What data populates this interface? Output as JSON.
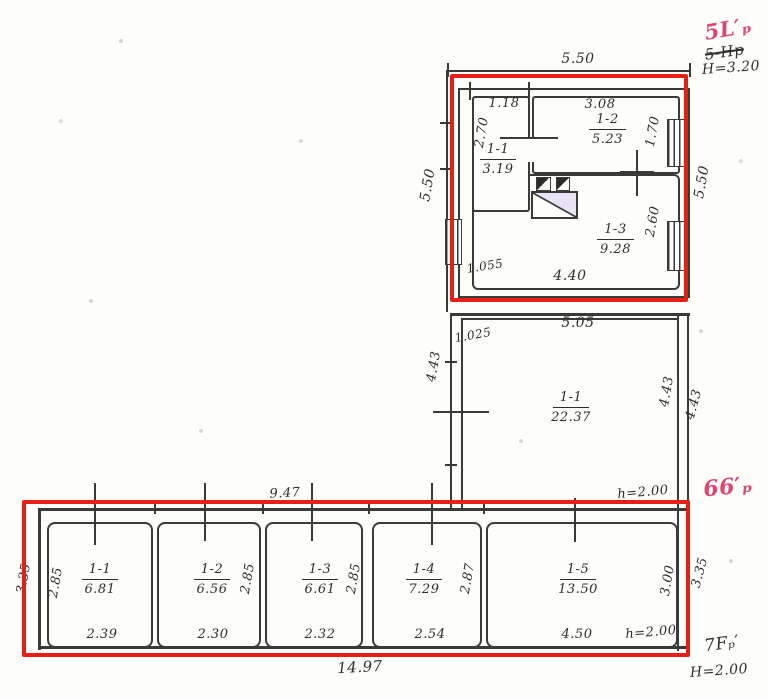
{
  "colors": {
    "red_box": "#e81f15",
    "pink": "#e0476f",
    "ink": "#3a3a38"
  },
  "annotations": {
    "top_right": {
      "pink_label": "5L′ₚ",
      "struck_label": "5-Hp",
      "height_note": "H=3.20"
    },
    "mid_right": {
      "pink_label": "66′ₚ"
    },
    "bottom_right": {
      "label": "7Fₚ′",
      "height_note": "H=2.00"
    }
  },
  "top_unit": {
    "dim_top": "5.50",
    "dim_left": "5.50",
    "dim_right": "5.50",
    "dim_small": "1.055",
    "dim_bottom": "4.40",
    "rooms": [
      {
        "id": "1-1",
        "area": "3.19",
        "dim_w": "1.18",
        "dim_h": "2.70"
      },
      {
        "id": "1-2",
        "area": "5.23",
        "dim_w": "3.08",
        "dim_h": "1.70"
      },
      {
        "id": "1-3",
        "area": "9.28",
        "dim_h": "2.60"
      }
    ]
  },
  "mid_section": {
    "dim_top": "5.05",
    "dim_small": "1.025",
    "dim_left": "4.43",
    "dim_right_inner": "4.43",
    "dim_right_outer": "4.43",
    "dim_bottom": "9.47",
    "height_note": "h=2.00",
    "room": {
      "id": "1-1",
      "area": "22.37"
    }
  },
  "bottom_strip": {
    "dim_left_outer": "3.35",
    "dim_right_outer": "3.35",
    "dim_total": "14.97",
    "rooms": [
      {
        "id": "1-1",
        "area": "6.81",
        "dim_w": "2.39",
        "dim_h": "2.85"
      },
      {
        "id": "1-2",
        "area": "6.56",
        "dim_w": "2.30",
        "dim_h": "2.85"
      },
      {
        "id": "1-3",
        "area": "6.61",
        "dim_w": "2.32",
        "dim_h": "2.85"
      },
      {
        "id": "1-4",
        "area": "7.29",
        "dim_w": "2.54",
        "dim_h": "2.87"
      },
      {
        "id": "1-5",
        "area": "13.50",
        "dim_w": "4.50",
        "dim_h": "3.00",
        "height_note": "h=2.00"
      }
    ]
  }
}
